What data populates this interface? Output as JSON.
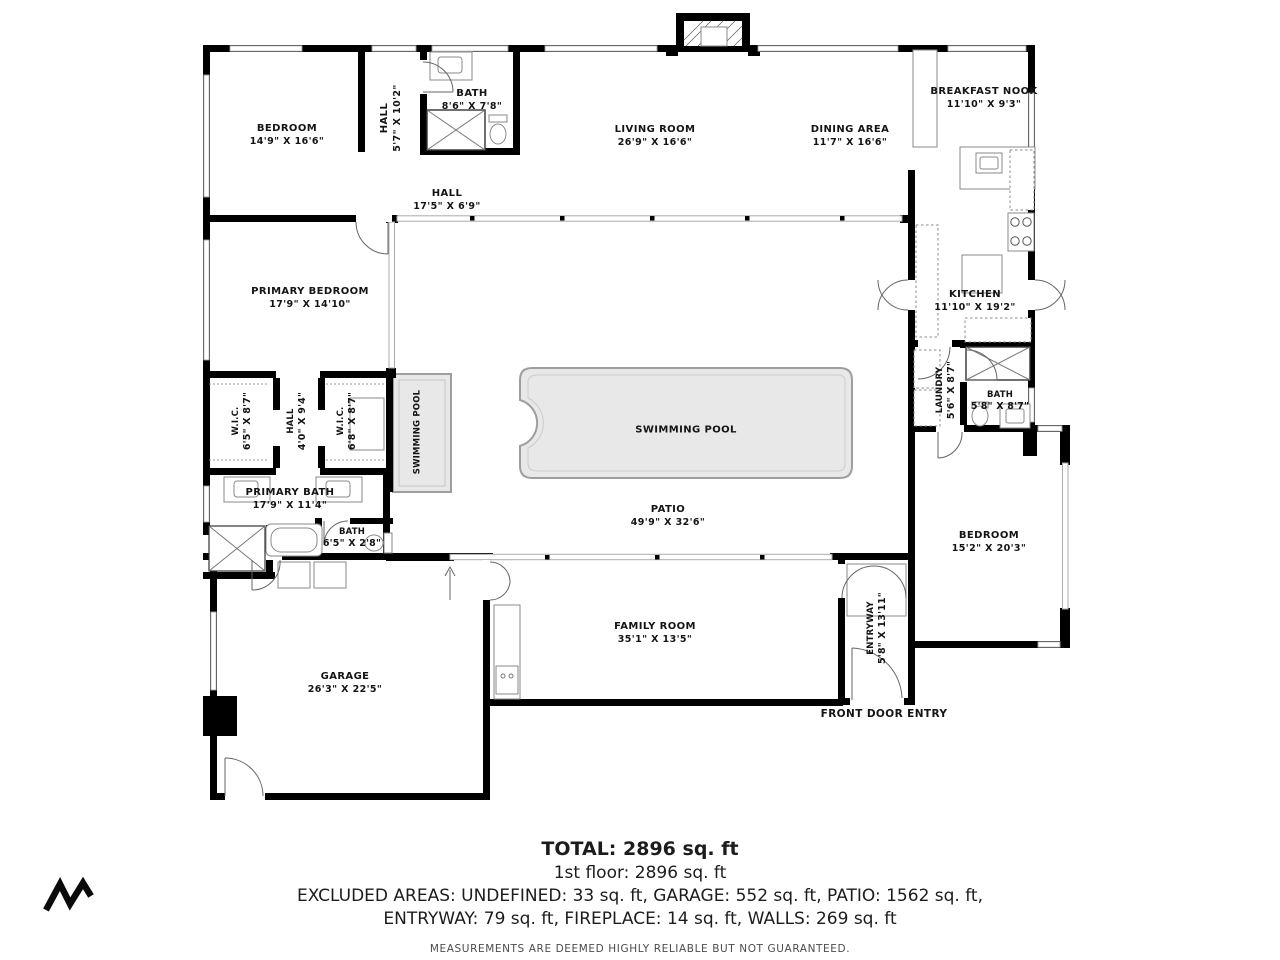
{
  "plan": {
    "rooms": [
      {
        "id": "bedroom-top-left",
        "name": "BEDROOM",
        "dims": "14'9\" X 16'6\""
      },
      {
        "id": "hall-upper",
        "name": "HALL",
        "dims": "5'7\" X 10'2\""
      },
      {
        "id": "bath-upper",
        "name": "BATH",
        "dims": "8'6\" X 7'8\""
      },
      {
        "id": "hall-main",
        "name": "HALL",
        "dims": "17'5\" X 6'9\""
      },
      {
        "id": "living-room",
        "name": "LIVING ROOM",
        "dims": "26'9\" X 16'6\""
      },
      {
        "id": "dining-area",
        "name": "DINING AREA",
        "dims": "11'7\" X 16'6\""
      },
      {
        "id": "breakfast-nook",
        "name": "BREAKFAST NOOK",
        "dims": "11'10\" X 9'3\""
      },
      {
        "id": "kitchen",
        "name": "KITCHEN",
        "dims": "11'10\" X 19'2\""
      },
      {
        "id": "laundry",
        "name": "LAUNDRY",
        "dims": "5'6\" X 8'7\""
      },
      {
        "id": "bath-right",
        "name": "BATH",
        "dims": "5'8\" X 8'7\""
      },
      {
        "id": "primary-bedroom",
        "name": "PRIMARY BEDROOM",
        "dims": "17'9\" X 14'10\""
      },
      {
        "id": "wic-left",
        "name": "W.I.C.",
        "dims": "6'5\" X 8'7\""
      },
      {
        "id": "hall-wic",
        "name": "HALL",
        "dims": "4'0\" X 9'4\""
      },
      {
        "id": "wic-right",
        "name": "W.I.C.",
        "dims": "6'8\" X 8'7\""
      },
      {
        "id": "swimming-pool-small",
        "name": "SWIMMING POOL",
        "dims": ""
      },
      {
        "id": "swimming-pool-main",
        "name": "SWIMMING POOL",
        "dims": ""
      },
      {
        "id": "patio",
        "name": "PATIO",
        "dims": "49'9\" X 32'6\""
      },
      {
        "id": "primary-bath",
        "name": "PRIMARY BATH",
        "dims": "17'9\" X 11'4\""
      },
      {
        "id": "bath-small",
        "name": "BATH",
        "dims": "6'5\" X 2'8\""
      },
      {
        "id": "garage",
        "name": "GARAGE",
        "dims": "26'3\" X 22'5\""
      },
      {
        "id": "family-room",
        "name": "FAMILY ROOM",
        "dims": "35'1\" X 13'5\""
      },
      {
        "id": "entryway",
        "name": "ENTRYWAY",
        "dims": "5'8\" X 13'11\""
      },
      {
        "id": "bedroom-right",
        "name": "BEDROOM",
        "dims": "15'2\" X 20'3\""
      },
      {
        "id": "front-door-entry",
        "name": "FRONT DOOR ENTRY",
        "dims": ""
      }
    ],
    "footer": {
      "total": "TOTAL: 2896 sq. ft",
      "floor1": "1st floor: 2896 sq. ft",
      "excluded1": "EXCLUDED AREAS: UNDEFINED: 33 sq. ft, GARAGE: 552 sq. ft, PATIO: 1562 sq. ft,",
      "excluded2": "ENTRYWAY: 79 sq. ft, FIREPLACE: 14 sq. ft, WALLS: 269 sq. ft",
      "disclaimer": "MEASUREMENTS ARE DEEMED HIGHLY RELIABLE BUT NOT GUARANTEED."
    },
    "colors": {
      "wall": "#000000",
      "window_frame": "#9e9e9e",
      "slider": "#aaaaaa",
      "pool_fill": "#e8e8e8",
      "pool_border": "#9e9e9e",
      "text": "#141414"
    }
  }
}
